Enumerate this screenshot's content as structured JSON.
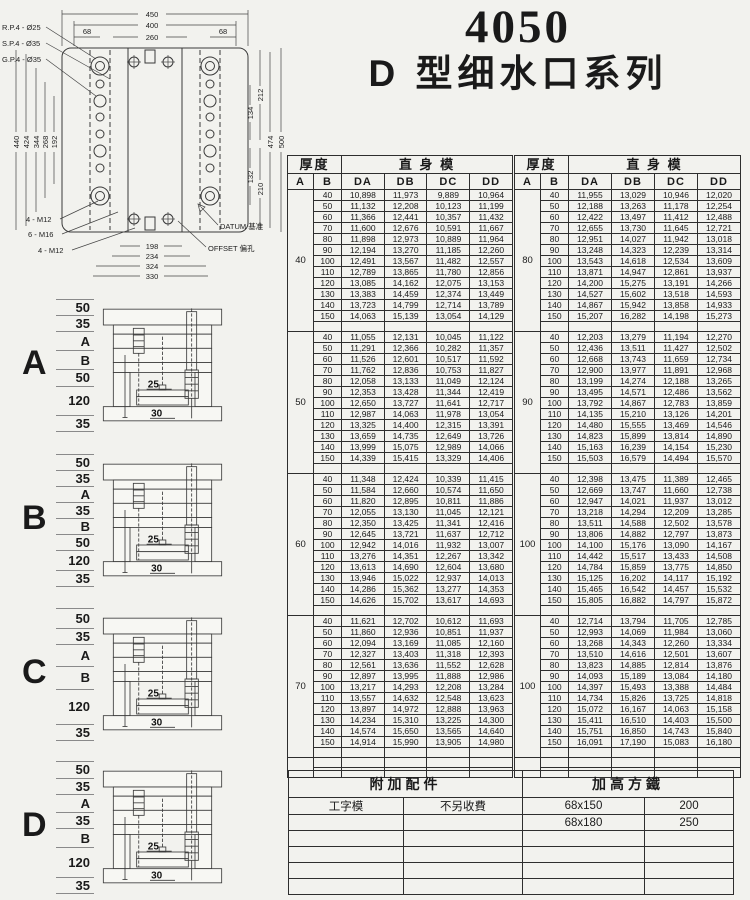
{
  "title": {
    "number": "4050",
    "series": "D 型细水口系列"
  },
  "plan": {
    "callouts": {
      "rp": "R.P.4 - Ø25",
      "sp": "S.P.4 - Ø35",
      "gp": "G.P.4 - Ø35",
      "m12_top": "4 - M12",
      "m16": "6 - M16",
      "m12_bottom": "4 - M12",
      "datum": "DATUM 基准",
      "offset": "OFFSET 偏孔"
    },
    "dims": {
      "d450": "450",
      "d400": "400",
      "d260": "260",
      "d68l": "68",
      "d68r": "68",
      "d440": "440",
      "d424": "424",
      "d344": "344",
      "d268": "268",
      "d192": "192",
      "d212": "212",
      "d134": "134",
      "d132": "132",
      "d210": "210",
      "d474": "474",
      "d500": "500",
      "d198": "198",
      "d234": "234",
      "d324": "324",
      "d330": "330"
    }
  },
  "price_header": {
    "thickness": "厚度",
    "col_a": "A",
    "col_b": "B",
    "straight": "直 身 模",
    "cols": [
      "DA",
      "DB",
      "DC",
      "DD"
    ]
  },
  "price_tables": [
    {
      "blocks": [
        {
          "a": "40",
          "rows": [
            [
              "40",
              "10,898",
              "11,973",
              "9,889",
              "10,964"
            ],
            [
              "50",
              "11,132",
              "12,208",
              "10,123",
              "11,199"
            ],
            [
              "60",
              "11,366",
              "12,441",
              "10,357",
              "11,432"
            ],
            [
              "70",
              "11,600",
              "12,676",
              "10,591",
              "11,667"
            ],
            [
              "80",
              "11,898",
              "12,973",
              "10,889",
              "11,964"
            ],
            [
              "90",
              "12,194",
              "13,270",
              "11,185",
              "12,260"
            ],
            [
              "100",
              "12,491",
              "13,567",
              "11,482",
              "12,557"
            ],
            [
              "110",
              "12,789",
              "13,865",
              "11,780",
              "12,856"
            ],
            [
              "120",
              "13,085",
              "14,162",
              "12,075",
              "13,153"
            ],
            [
              "130",
              "13,383",
              "14,459",
              "12,374",
              "13,449"
            ],
            [
              "140",
              "13,723",
              "14,799",
              "12,714",
              "13,789"
            ],
            [
              "150",
              "14,063",
              "15,139",
              "13,054",
              "14,129"
            ]
          ]
        },
        {
          "a": "50",
          "rows": [
            [
              "40",
              "11,055",
              "12,131",
              "10,045",
              "11,122"
            ],
            [
              "50",
              "11,291",
              "12,366",
              "10,282",
              "11,357"
            ],
            [
              "60",
              "11,526",
              "12,601",
              "10,517",
              "11,592"
            ],
            [
              "70",
              "11,762",
              "12,836",
              "10,753",
              "11,827"
            ],
            [
              "80",
              "12,058",
              "13,133",
              "11,049",
              "12,124"
            ],
            [
              "90",
              "12,353",
              "13,428",
              "11,344",
              "12,419"
            ],
            [
              "100",
              "12,650",
              "13,727",
              "11,641",
              "12,717"
            ],
            [
              "110",
              "12,987",
              "14,063",
              "11,978",
              "13,054"
            ],
            [
              "120",
              "13,325",
              "14,400",
              "12,315",
              "13,391"
            ],
            [
              "130",
              "13,659",
              "14,735",
              "12,649",
              "13,726"
            ],
            [
              "140",
              "13,999",
              "15,075",
              "12,989",
              "14,066"
            ],
            [
              "150",
              "14,339",
              "15,415",
              "13,329",
              "14,406"
            ]
          ]
        },
        {
          "a": "60",
          "rows": [
            [
              "40",
              "11,348",
              "12,424",
              "10,339",
              "11,415"
            ],
            [
              "50",
              "11,584",
              "12,660",
              "10,574",
              "11,650"
            ],
            [
              "60",
              "11,820",
              "12,895",
              "10,811",
              "11,886"
            ],
            [
              "70",
              "12,055",
              "13,130",
              "11,045",
              "12,121"
            ],
            [
              "80",
              "12,350",
              "13,425",
              "11,341",
              "12,416"
            ],
            [
              "90",
              "12,645",
              "13,721",
              "11,637",
              "12,712"
            ],
            [
              "100",
              "12,942",
              "14,016",
              "11,932",
              "13,007"
            ],
            [
              "110",
              "13,276",
              "14,351",
              "12,267",
              "13,342"
            ],
            [
              "120",
              "13,613",
              "14,690",
              "12,604",
              "13,680"
            ],
            [
              "130",
              "13,946",
              "15,022",
              "12,937",
              "14,013"
            ],
            [
              "140",
              "14,286",
              "15,362",
              "13,277",
              "14,353"
            ],
            [
              "150",
              "14,626",
              "15,702",
              "13,617",
              "14,693"
            ]
          ]
        },
        {
          "a": "70",
          "rows": [
            [
              "40",
              "11,621",
              "12,702",
              "10,612",
              "11,693"
            ],
            [
              "50",
              "11,860",
              "12,936",
              "10,851",
              "11,937"
            ],
            [
              "60",
              "12,094",
              "13,169",
              "11,085",
              "12,160"
            ],
            [
              "70",
              "12,327",
              "13,403",
              "11,318",
              "12,393"
            ],
            [
              "80",
              "12,561",
              "13,636",
              "11,552",
              "12,628"
            ],
            [
              "90",
              "12,897",
              "13,995",
              "11,888",
              "12,986"
            ],
            [
              "100",
              "13,217",
              "14,293",
              "12,208",
              "13,284"
            ],
            [
              "110",
              "13,557",
              "14,632",
              "12,548",
              "13,623"
            ],
            [
              "120",
              "13,897",
              "14,972",
              "12,888",
              "13,963"
            ],
            [
              "130",
              "14,234",
              "15,310",
              "13,225",
              "14,300"
            ],
            [
              "140",
              "14,574",
              "15,650",
              "13,565",
              "14,640"
            ],
            [
              "150",
              "14,914",
              "15,990",
              "13,905",
              "14,980"
            ]
          ]
        }
      ]
    },
    {
      "blocks": [
        {
          "a": "80",
          "rows": [
            [
              "40",
              "11,955",
              "13,029",
              "10,946",
              "12,020"
            ],
            [
              "50",
              "12,188",
              "13,263",
              "11,178",
              "12,254"
            ],
            [
              "60",
              "12,422",
              "13,497",
              "11,412",
              "12,488"
            ],
            [
              "70",
              "12,655",
              "13,730",
              "11,645",
              "12,721"
            ],
            [
              "80",
              "12,951",
              "14,027",
              "11,942",
              "13,018"
            ],
            [
              "90",
              "13,248",
              "14,323",
              "12,239",
              "13,314"
            ],
            [
              "100",
              "13,543",
              "14,618",
              "12,534",
              "13,609"
            ],
            [
              "110",
              "13,871",
              "14,947",
              "12,861",
              "13,937"
            ],
            [
              "120",
              "14,200",
              "15,275",
              "13,191",
              "14,266"
            ],
            [
              "130",
              "14,527",
              "15,602",
              "13,518",
              "14,593"
            ],
            [
              "140",
              "14,867",
              "15,942",
              "13,858",
              "14,933"
            ],
            [
              "150",
              "15,207",
              "16,282",
              "14,198",
              "15,273"
            ]
          ]
        },
        {
          "a": "90",
          "rows": [
            [
              "40",
              "12,203",
              "13,279",
              "11,194",
              "12,270"
            ],
            [
              "50",
              "12,436",
              "13,511",
              "11,427",
              "12,502"
            ],
            [
              "60",
              "12,668",
              "13,743",
              "11,659",
              "12,734"
            ],
            [
              "70",
              "12,900",
              "13,977",
              "11,891",
              "12,968"
            ],
            [
              "80",
              "13,199",
              "14,274",
              "12,188",
              "13,265"
            ],
            [
              "90",
              "13,495",
              "14,571",
              "12,486",
              "13,562"
            ],
            [
              "100",
              "13,792",
              "14,867",
              "12,783",
              "13,859"
            ],
            [
              "110",
              "14,135",
              "15,210",
              "13,126",
              "14,201"
            ],
            [
              "120",
              "14,480",
              "15,555",
              "13,469",
              "14,546"
            ],
            [
              "130",
              "14,823",
              "15,899",
              "13,814",
              "14,890"
            ],
            [
              "140",
              "15,163",
              "16,239",
              "14,154",
              "15,230"
            ],
            [
              "150",
              "15,503",
              "16,579",
              "14,494",
              "15,570"
            ]
          ]
        },
        {
          "a": "100",
          "rows": [
            [
              "40",
              "12,398",
              "13,475",
              "11,389",
              "12,465"
            ],
            [
              "50",
              "12,669",
              "13,747",
              "11,660",
              "12,738"
            ],
            [
              "60",
              "12,947",
              "14,021",
              "11,937",
              "13,012"
            ],
            [
              "70",
              "13,218",
              "14,294",
              "12,209",
              "13,285"
            ],
            [
              "80",
              "13,511",
              "14,588",
              "12,502",
              "13,578"
            ],
            [
              "90",
              "13,806",
              "14,882",
              "12,797",
              "13,873"
            ],
            [
              "100",
              "14,100",
              "15,176",
              "13,090",
              "14,167"
            ],
            [
              "110",
              "14,442",
              "15,517",
              "13,433",
              "14,508"
            ],
            [
              "120",
              "14,784",
              "15,859",
              "13,775",
              "14,850"
            ],
            [
              "130",
              "15,125",
              "16,202",
              "14,117",
              "15,192"
            ],
            [
              "140",
              "15,465",
              "16,542",
              "14,457",
              "15,532"
            ],
            [
              "150",
              "15,805",
              "16,882",
              "14,797",
              "15,872"
            ]
          ]
        },
        {
          "a": "100",
          "rows": [
            [
              "40",
              "12,714",
              "13,794",
              "11,705",
              "12,785"
            ],
            [
              "50",
              "12,993",
              "14,069",
              "11,984",
              "13,060"
            ],
            [
              "60",
              "13,268",
              "14,343",
              "12,260",
              "13,334"
            ],
            [
              "70",
              "13,510",
              "14,616",
              "12,501",
              "13,607"
            ],
            [
              "80",
              "13,823",
              "14,885",
              "12,814",
              "13,876"
            ],
            [
              "90",
              "14,093",
              "15,189",
              "13,084",
              "14,180"
            ],
            [
              "100",
              "14,397",
              "15,493",
              "13,388",
              "14,484"
            ],
            [
              "110",
              "14,734",
              "15,826",
              "13,725",
              "14,818"
            ],
            [
              "120",
              "15,072",
              "16,167",
              "14,063",
              "15,158"
            ],
            [
              "130",
              "15,411",
              "16,510",
              "14,403",
              "15,500"
            ],
            [
              "140",
              "15,751",
              "16,850",
              "14,743",
              "15,840"
            ],
            [
              "150",
              "16,091",
              "17,190",
              "15,083",
              "16,180"
            ]
          ]
        }
      ]
    }
  ],
  "sections": [
    {
      "label": "A",
      "dims": [
        "50",
        "35",
        "A",
        "B",
        "50",
        "120",
        "35"
      ],
      "inner_top": "25",
      "inner_bottom": "30"
    },
    {
      "label": "B",
      "dims": [
        "50",
        "35",
        "A",
        "35",
        "B",
        "50",
        "120",
        "35"
      ],
      "inner_top": "25",
      "inner_bottom": "30"
    },
    {
      "label": "C",
      "dims": [
        "50",
        "35",
        "A",
        "B",
        "120",
        "35"
      ],
      "inner_top": "25",
      "inner_bottom": "30"
    },
    {
      "label": "D",
      "dims": [
        "50",
        "35",
        "A",
        "35",
        "B",
        "120",
        "35"
      ],
      "inner_top": "25",
      "inner_bottom": "30"
    }
  ],
  "accessories": {
    "header_left": "附加配件",
    "header_right": "加高方鐵",
    "rows": [
      [
        "工字模",
        "不另收費",
        "68x150",
        "200"
      ],
      [
        "",
        "",
        "68x180",
        "250"
      ],
      [
        "",
        "",
        "",
        ""
      ],
      [
        "",
        "",
        "",
        ""
      ],
      [
        "",
        "",
        "",
        ""
      ],
      [
        "",
        "",
        "",
        ""
      ]
    ]
  }
}
